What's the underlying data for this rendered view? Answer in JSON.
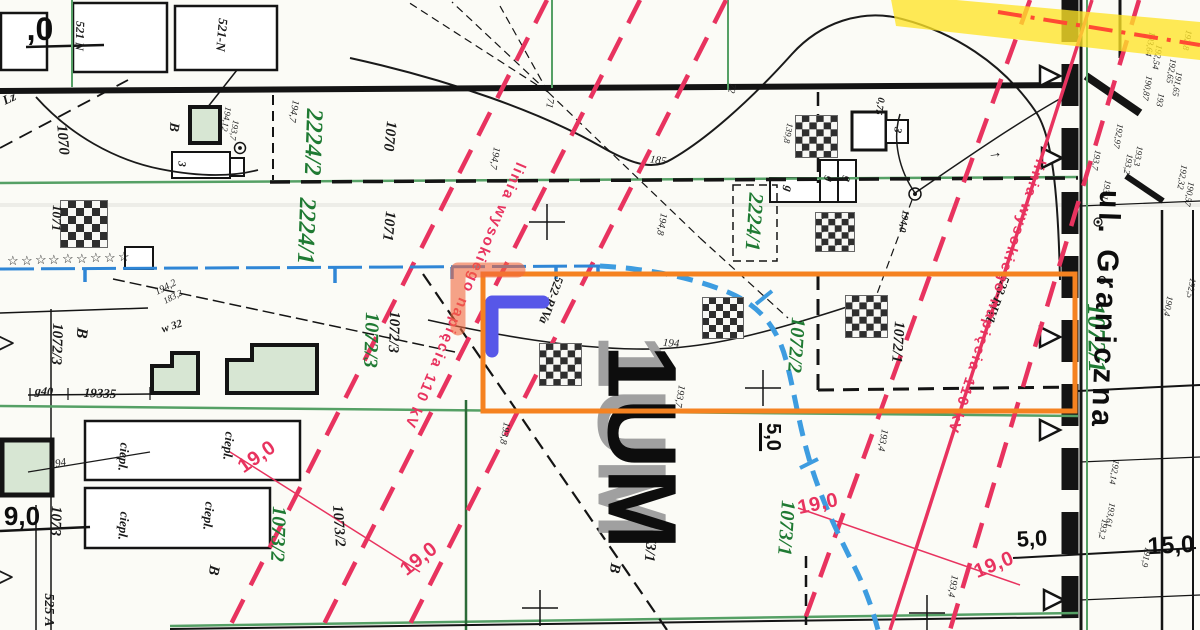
{
  "map_type_note": "scanned cadastral / zoning map with selection overlay",
  "colors": {
    "paper": "#fbfbf6",
    "ink": "#141414",
    "parcel_green": "#1f7a33",
    "boundary_green": "#55a065",
    "hv_red": "#e8335f",
    "water_blue": "#2f86d6",
    "stream_blue": "#3d9ce0",
    "selection_orange": "#f58220",
    "marker_blue": "#5757e8",
    "marker_salmon": "#f2673e",
    "highlight_yellow": "#ffe428",
    "centerline_red": "#ff4a33",
    "building_fill": "#d7e6d3"
  },
  "zone_designation": "1UM",
  "street_name": "ul. Graniczna",
  "hv_line_label": "linia wysokiego napięcia 110 kV",
  "labels": [
    {
      "t": "2224/2",
      "x": 313,
      "y": 142,
      "r": 92,
      "s": 24,
      "c": "g",
      "n": "parcel-number"
    },
    {
      "t": "2224/1",
      "x": 306,
      "y": 231,
      "r": 92,
      "s": 24,
      "c": "g",
      "n": "parcel-number"
    },
    {
      "t": "2224/1",
      "x": 754,
      "y": 222,
      "r": 94,
      "s": 21,
      "c": "g",
      "n": "parcel-number"
    },
    {
      "t": "1072/3",
      "x": 371,
      "y": 340,
      "r": 92,
      "s": 20,
      "c": "g",
      "n": "parcel-number"
    },
    {
      "t": "1072/2",
      "x": 796,
      "y": 345,
      "r": 94,
      "s": 20,
      "c": "g",
      "n": "parcel-number"
    },
    {
      "t": "1073/2",
      "x": 278,
      "y": 534,
      "r": 92,
      "s": 20,
      "c": "g",
      "n": "parcel-number"
    },
    {
      "t": "1073/1",
      "x": 786,
      "y": 528,
      "r": 94,
      "s": 20,
      "c": "g",
      "n": "parcel-number"
    },
    {
      "t": "1072/1",
      "x": 1096,
      "y": 338,
      "r": 89,
      "s": 25,
      "c": "g",
      "n": "parcel-number"
    },
    {
      "t": "1070",
      "x": 62,
      "y": 140,
      "r": 85,
      "s": 15,
      "c": "b",
      "n": "parcel-number"
    },
    {
      "t": "1070",
      "x": 389,
      "y": 136,
      "r": 96,
      "s": 15,
      "c": "b",
      "n": "parcel-number"
    },
    {
      "t": "1071",
      "x": 388,
      "y": 226,
      "r": 96,
      "s": 15,
      "c": "b",
      "n": "parcel-number"
    },
    {
      "t": "1071",
      "x": 57,
      "y": 218,
      "r": 92,
      "s": 13,
      "c": "b",
      "n": "parcel-number"
    },
    {
      "t": "1072/3",
      "x": 56,
      "y": 344,
      "r": 92,
      "s": 15,
      "c": "b",
      "n": "parcel-number"
    },
    {
      "t": "1072/3",
      "x": 393,
      "y": 332,
      "r": 92,
      "s": 15,
      "c": "b",
      "n": "parcel-number"
    },
    {
      "t": "1072/1",
      "x": 897,
      "y": 342,
      "r": 94,
      "s": 15,
      "c": "b",
      "n": "parcel-number"
    },
    {
      "t": "1073/2",
      "x": 338,
      "y": 526,
      "r": 86,
      "s": 15,
      "c": "b",
      "n": "parcel-number"
    },
    {
      "t": "1073/1",
      "x": 650,
      "y": 541,
      "r": 95,
      "s": 15,
      "c": "b",
      "n": "parcel-number"
    },
    {
      "t": "1073",
      "x": 55,
      "y": 521,
      "r": 92,
      "s": 15,
      "c": "b",
      "n": "parcel-number"
    },
    {
      "t": "525 A",
      "x": 48,
      "y": 610,
      "r": 90,
      "s": 14,
      "c": "b",
      "n": "parcel-number"
    },
    {
      "t": "521 N",
      "x": 80,
      "y": 36,
      "r": 92,
      "s": 12,
      "c": "b",
      "n": "parcel-number"
    },
    {
      "t": "521-N",
      "x": 222,
      "y": 35,
      "r": 95,
      "s": 13,
      "c": "b",
      "n": "parcel-number"
    },
    {
      "t": "B",
      "x": 81,
      "y": 333,
      "r": 96,
      "s": 16,
      "c": "b",
      "n": "land-use-code"
    },
    {
      "t": "B",
      "x": 173,
      "y": 127,
      "r": 96,
      "s": 14,
      "c": "b",
      "n": "land-use-code"
    },
    {
      "t": "B",
      "x": 213,
      "y": 570,
      "r": 100,
      "s": 15,
      "c": "b",
      "n": "land-use-code"
    },
    {
      "t": "B",
      "x": 614,
      "y": 568,
      "r": 100,
      "s": 15,
      "c": "b",
      "n": "land-use-code"
    },
    {
      "t": "Lz",
      "x": 9,
      "y": 98,
      "r": -25,
      "s": 13,
      "c": "b",
      "n": "land-use-code"
    },
    {
      "t": "g40",
      "x": 44,
      "y": 391,
      "r": 4,
      "s": 12,
      "c": "b",
      "n": "dimension-label"
    },
    {
      "t": "19335",
      "x": 100,
      "y": 393,
      "r": 2,
      "s": 13,
      "c": "b",
      "n": "dimension-label"
    },
    {
      "t": "w 32",
      "x": 172,
      "y": 327,
      "r": -18,
      "s": 11,
      "c": "b",
      "n": "annotation"
    },
    {
      "t": "3",
      "x": 181,
      "y": 164,
      "r": 92,
      "s": 11,
      "c": "b",
      "n": "building-label"
    },
    {
      "t": "3",
      "x": 897,
      "y": 130,
      "r": 100,
      "s": 11,
      "c": "b",
      "n": "building-label"
    },
    {
      "t": "g",
      "x": 789,
      "y": 189,
      "r": 100,
      "s": 12,
      "c": "b",
      "n": "building-label"
    },
    {
      "t": "g",
      "x": 829,
      "y": 179,
      "r": 100,
      "s": 11,
      "c": "b",
      "n": "building-label"
    },
    {
      "t": "g",
      "x": 847,
      "y": 179,
      "r": 100,
      "s": 11,
      "c": "b",
      "n": "building-label"
    },
    {
      "t": "0,75",
      "x": 879,
      "y": 106,
      "r": 100,
      "s": 10,
      "c": "b",
      "n": "annotation"
    },
    {
      "t": "194,0",
      "x": 903,
      "y": 221,
      "r": 100,
      "s": 10,
      "c": "b",
      "n": "elevation-label"
    },
    {
      "t": "ciepl.",
      "x": 124,
      "y": 457,
      "r": 95,
      "s": 13,
      "c": "b",
      "n": "building-label"
    },
    {
      "t": "ciepl.",
      "x": 229,
      "y": 446,
      "r": 95,
      "s": 13,
      "c": "b",
      "n": "building-label"
    },
    {
      "t": "ciepl.",
      "x": 124,
      "y": 526,
      "r": 95,
      "s": 13,
      "c": "b",
      "n": "building-label"
    },
    {
      "t": "ciepl.",
      "x": 209,
      "y": 516,
      "r": 95,
      "s": 13,
      "c": "b",
      "n": "building-label"
    },
    {
      "t": "522-RIVa",
      "x": 551,
      "y": 300,
      "r": 110,
      "s": 12.5,
      "c": "b",
      "n": "soil-class-label"
    },
    {
      "t": "523-RIVb",
      "x": 997,
      "y": 300,
      "r": 110,
      "s": 12.5,
      "c": "b",
      "n": "soil-class-label"
    },
    {
      "t": ">",
      "x": 6,
      "y": 344,
      "r": 0,
      "s": 30,
      "c": "b",
      "n": "arrow-symbol"
    },
    {
      "t": ">",
      "x": 5,
      "y": 578,
      "r": 0,
      "s": 30,
      "c": "b",
      "n": "arrow-symbol"
    },
    {
      "t": "→",
      "x": 995,
      "y": 154,
      "r": -8,
      "s": 15,
      "c": "b",
      "n": "arrow-symbol"
    },
    {
      "t": "194,7",
      "x": 293,
      "y": 111,
      "r": 100,
      "s": 10,
      "c": "t",
      "n": "elevation-label"
    },
    {
      "t": "194,7",
      "x": 494,
      "y": 158,
      "r": 100,
      "s": 10,
      "c": "t",
      "n": "elevation-label"
    },
    {
      "t": "185",
      "x": 658,
      "y": 161,
      "r": 8,
      "s": 11,
      "c": "t",
      "n": "contour-label"
    },
    {
      "t": "194,8",
      "x": 661,
      "y": 224,
      "r": 100,
      "s": 10,
      "c": "t",
      "n": "elevation-label"
    },
    {
      "t": "194",
      "x": 671,
      "y": 344,
      "r": 4,
      "s": 11,
      "c": "t",
      "n": "contour-label"
    },
    {
      "t": "193,7",
      "x": 679,
      "y": 396,
      "r": 100,
      "s": 10,
      "c": "t",
      "n": "elevation-label"
    },
    {
      "t": "193,8",
      "x": 504,
      "y": 433,
      "r": 100,
      "s": 10,
      "c": "t",
      "n": "elevation-label"
    },
    {
      "t": "193,4",
      "x": 882,
      "y": 440,
      "r": 100,
      "s": 10,
      "c": "t",
      "n": "elevation-label"
    },
    {
      "t": "193,4",
      "x": 952,
      "y": 586,
      "r": 100,
      "s": 10,
      "c": "t",
      "n": "elevation-label"
    },
    {
      "t": "194",
      "x": 58,
      "y": 464,
      "r": -10,
      "s": 11,
      "c": "t",
      "n": "contour-label"
    },
    {
      "t": "194,2",
      "x": 166,
      "y": 288,
      "r": -28,
      "s": 10,
      "c": "t",
      "n": "elevation-label"
    },
    {
      "t": "183,2",
      "x": 173,
      "y": 297,
      "r": -28,
      "s": 9,
      "c": "t",
      "n": "elevation-label"
    },
    {
      "t": "194,12",
      "x": 226,
      "y": 119,
      "r": 100,
      "s": 9,
      "c": "t",
      "n": "elevation-label"
    },
    {
      "t": "193,7",
      "x": 234,
      "y": 130,
      "r": 100,
      "s": 9,
      "c": "t",
      "n": "elevation-label"
    },
    {
      "t": "139,8",
      "x": 788,
      "y": 133,
      "r": 100,
      "s": 9,
      "c": "t",
      "n": "elevation-label"
    },
    {
      "t": "72",
      "x": 731,
      "y": 88,
      "r": 100,
      "s": 10,
      "c": "t",
      "n": "annotation"
    },
    {
      "t": "71",
      "x": 549,
      "y": 103,
      "r": 100,
      "s": 10,
      "c": "t",
      "n": "annotation"
    },
    {
      "t": "192,8",
      "x": 1187,
      "y": 40,
      "r": 100,
      "s": 9,
      "c": "t",
      "n": "elevation-label"
    },
    {
      "t": "193,64",
      "x": 1150,
      "y": 44,
      "r": 100,
      "s": 9,
      "c": "t",
      "n": "elevation-label"
    },
    {
      "t": "192,54",
      "x": 1157,
      "y": 57,
      "r": 100,
      "s": 9,
      "c": "t",
      "n": "elevation-label"
    },
    {
      "t": "190,87",
      "x": 1147,
      "y": 88,
      "r": 100,
      "s": 9,
      "c": "t",
      "n": "elevation-label"
    },
    {
      "t": "192,65",
      "x": 1171,
      "y": 71,
      "r": 100,
      "s": 9,
      "c": "t",
      "n": "elevation-label"
    },
    {
      "t": "191,65",
      "x": 1177,
      "y": 84,
      "r": 100,
      "s": 9,
      "c": "t",
      "n": "elevation-label"
    },
    {
      "t": "193",
      "x": 1160,
      "y": 100,
      "r": 100,
      "s": 9,
      "c": "t",
      "n": "elevation-label"
    },
    {
      "t": "192,97",
      "x": 1118,
      "y": 136,
      "r": 100,
      "s": 9,
      "c": "t",
      "n": "elevation-label"
    },
    {
      "t": "193,3",
      "x": 1138,
      "y": 156,
      "r": 100,
      "s": 9,
      "c": "t",
      "n": "elevation-label"
    },
    {
      "t": "193,7",
      "x": 1096,
      "y": 160,
      "r": 100,
      "s": 9,
      "c": "t",
      "n": "elevation-label"
    },
    {
      "t": "193,2",
      "x": 1128,
      "y": 164,
      "r": 100,
      "s": 9,
      "c": "t",
      "n": "elevation-label"
    },
    {
      "t": "192,32",
      "x": 1182,
      "y": 177,
      "r": 100,
      "s": 9,
      "c": "t",
      "n": "elevation-label"
    },
    {
      "t": "190,57",
      "x": 1189,
      "y": 194,
      "r": 100,
      "s": 9,
      "c": "t",
      "n": "elevation-label"
    },
    {
      "t": "193,1",
      "x": 1106,
      "y": 190,
      "r": 100,
      "s": 9,
      "c": "t",
      "n": "elevation-label"
    },
    {
      "t": "192,5",
      "x": 1191,
      "y": 288,
      "r": 100,
      "s": 9,
      "c": "t",
      "n": "elevation-label"
    },
    {
      "t": "190,4",
      "x": 1168,
      "y": 306,
      "r": 100,
      "s": 9,
      "c": "t",
      "n": "elevation-label"
    },
    {
      "t": "192,14",
      "x": 1114,
      "y": 472,
      "r": 100,
      "s": 9,
      "c": "t",
      "n": "elevation-label"
    },
    {
      "t": "193,61",
      "x": 1110,
      "y": 515,
      "r": 100,
      "s": 9,
      "c": "t",
      "n": "elevation-label"
    },
    {
      "t": "193,2",
      "x": 1103,
      "y": 529,
      "r": 100,
      "s": 9,
      "c": "t",
      "n": "elevation-label"
    },
    {
      "t": "191,9",
      "x": 1146,
      "y": 557,
      "r": 100,
      "s": 9,
      "c": "t",
      "n": "elevation-label"
    },
    {
      "t": "19,0",
      "x": 257,
      "y": 457,
      "r": -35,
      "s": 20,
      "c": "r",
      "n": "hv-clearance-label"
    },
    {
      "t": "19,0",
      "x": 419,
      "y": 559,
      "r": -38,
      "s": 20,
      "c": "r",
      "n": "hv-clearance-label"
    },
    {
      "t": "19,0",
      "x": 818,
      "y": 504,
      "r": -12,
      "s": 20,
      "c": "r",
      "n": "hv-clearance-label"
    },
    {
      "t": "19,0",
      "x": 994,
      "y": 565,
      "r": -22,
      "s": 20,
      "c": "r",
      "n": "hv-clearance-label"
    },
    {
      "t": "linia wysokiego napięcia 110 kV",
      "x": 528,
      "y": 166,
      "r": 113,
      "s": 15,
      "c": "r",
      "a": "tl",
      "ls": 2,
      "n": "hv-line-label"
    },
    {
      "t": "linia wysokiego napięcia 110 kV",
      "x": 1048,
      "y": 162,
      "r": 108,
      "s": 15,
      "c": "r",
      "a": "tl",
      "ls": 2,
      "n": "hv-line-label"
    },
    {
      "t": "1UM",
      "x": 632,
      "y": 437,
      "r": 90,
      "s": 97,
      "c": "k2",
      "n": "zone-designation-ghost"
    },
    {
      "t": "1UM",
      "x": 642,
      "y": 447,
      "r": 90,
      "s": 97,
      "c": "k",
      "n": "zone-designation"
    },
    {
      "t": "ul. Graniczna",
      "x": 1105,
      "y": 310,
      "r": 92,
      "s": 30,
      "c": "k",
      "ls": 4,
      "n": "street-name"
    },
    {
      "t": "5,0",
      "x": 771,
      "y": 437,
      "r": 90,
      "s": 20,
      "c": "k",
      "u": 1,
      "n": "dimension-label"
    },
    {
      "t": "5,0",
      "x": 1032,
      "y": 539,
      "r": -3,
      "s": 22,
      "c": "k",
      "n": "dimension-label"
    },
    {
      "t": "15,0",
      "x": 1171,
      "y": 546,
      "r": -3,
      "s": 24,
      "c": "k",
      "n": "dimension-label"
    },
    {
      "t": "9,0",
      "x": 22,
      "y": 516,
      "r": 0,
      "s": 26,
      "c": "k",
      "n": "dimension-label"
    },
    {
      "t": ",0",
      "x": 40,
      "y": 29,
      "r": 0,
      "s": 32,
      "c": "k",
      "n": "dimension-label"
    }
  ],
  "checkers": [
    {
      "x": 60,
      "y": 200,
      "s": 48
    },
    {
      "x": 795,
      "y": 115,
      "s": 43
    },
    {
      "x": 815,
      "y": 212,
      "s": 40
    },
    {
      "x": 702,
      "y": 297,
      "s": 42
    },
    {
      "x": 539,
      "y": 343,
      "s": 43
    },
    {
      "x": 845,
      "y": 295,
      "s": 43
    }
  ],
  "stars": [
    {
      "x": 7,
      "y": 262
    },
    {
      "x": 21,
      "y": 262
    },
    {
      "x": 35,
      "y": 261
    },
    {
      "x": 48,
      "y": 261
    },
    {
      "x": 62,
      "y": 260
    },
    {
      "x": 76,
      "y": 260
    },
    {
      "x": 90,
      "y": 259
    },
    {
      "x": 104,
      "y": 259
    },
    {
      "x": 118,
      "y": 258
    }
  ]
}
